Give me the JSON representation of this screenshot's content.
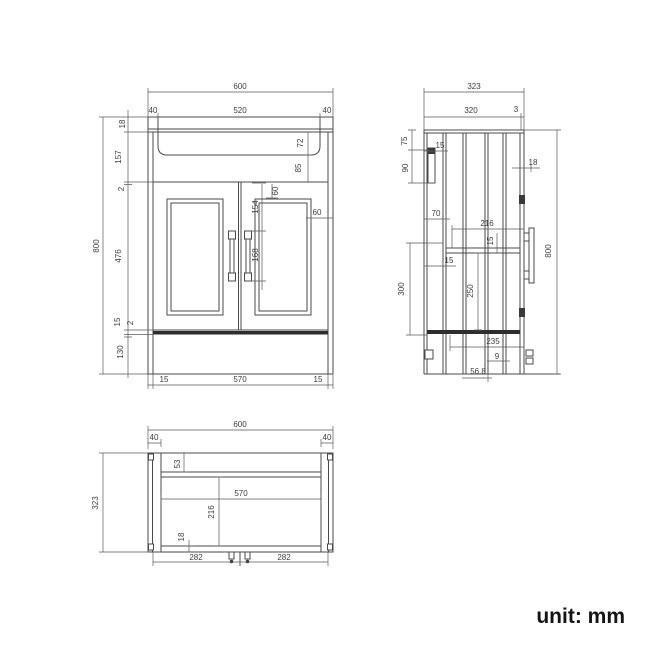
{
  "unit_label": "unit: mm",
  "front_view": {
    "total_width": "600",
    "basin_margin_left": "40",
    "basin_width": "520",
    "basin_margin_right": "40",
    "top_thickness": "18",
    "upper_section": "157",
    "gap_top": "2",
    "door_height": "476",
    "shelf_thickness": "15",
    "gap_bottom": "2",
    "plinth_height": "130",
    "total_height": "800",
    "basin_depth": "72",
    "basin_to_door": "85",
    "panel_offset_top": "60",
    "panel_offset_side": "60",
    "handle_offset": "154",
    "handle_length": "168",
    "base_left": "15",
    "base_width": "570",
    "base_right": "15"
  },
  "side_view": {
    "total_depth": "323",
    "body_depth": "320",
    "back_panel": "3",
    "bracket_offset": "75",
    "bracket_height": "90",
    "bracket_thickness": "15",
    "top_overhang": "18",
    "rail_offset": "70",
    "rail_depth": "216",
    "rail_thickness": "15",
    "back_inset": "15",
    "lower_height": "300",
    "inner_height": "250",
    "shelf_depth": "235",
    "plinth_recess": "9",
    "foot_offset": "56.8",
    "total_height": "800"
  },
  "bottom_view": {
    "total_width": "600",
    "margin_left": "40",
    "margin_right": "40",
    "total_depth": "323",
    "back_rail": "53",
    "inner_width": "570",
    "inner_depth": "216",
    "front_rail": "18",
    "fixing_left": "282",
    "fixing_right": "282"
  }
}
